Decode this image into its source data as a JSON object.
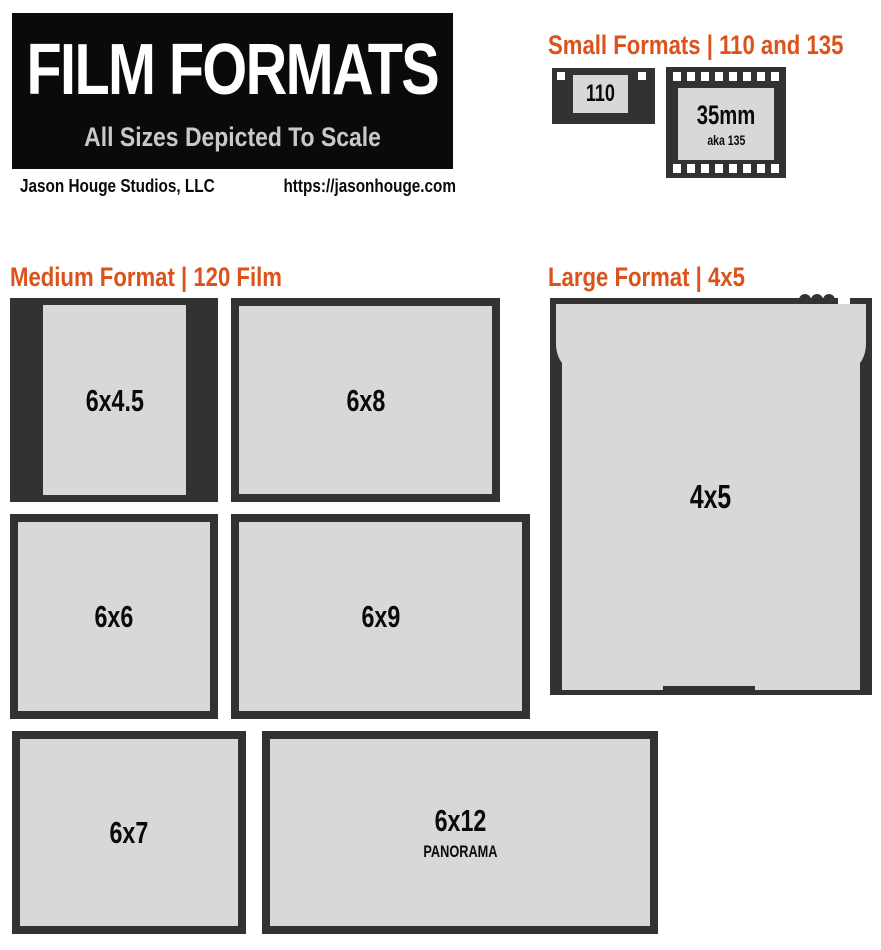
{
  "colors": {
    "accent_orange": "#db521b",
    "frame_dark": "#323232",
    "frame_light": "#d8d8d8",
    "subtitle_gray": "#c9c9c9",
    "header_black": "#0a0a0a"
  },
  "header": {
    "title": "FILM FORMATS",
    "subtitle": "All Sizes Depicted To Scale",
    "studio": "Jason Houge Studios, LLC",
    "website": "https://jasonhouge.com"
  },
  "sections": {
    "small": {
      "heading": "Small Formats | 110 and 135"
    },
    "medium": {
      "heading": "Medium Format | 120 Film"
    },
    "large": {
      "heading": "Large Format | 4x5"
    }
  },
  "small_formats": {
    "film_110": {
      "label": "110"
    },
    "film_135": {
      "label": "35mm",
      "sublabel": "aka 135"
    }
  },
  "medium_formats": [
    {
      "label": "6x4.5"
    },
    {
      "label": "6x8"
    },
    {
      "label": "6x6"
    },
    {
      "label": "6x9"
    },
    {
      "label": "6x7"
    },
    {
      "label": "6x12",
      "sublabel": "PANORAMA"
    }
  ],
  "large_format": {
    "label": "4x5"
  }
}
